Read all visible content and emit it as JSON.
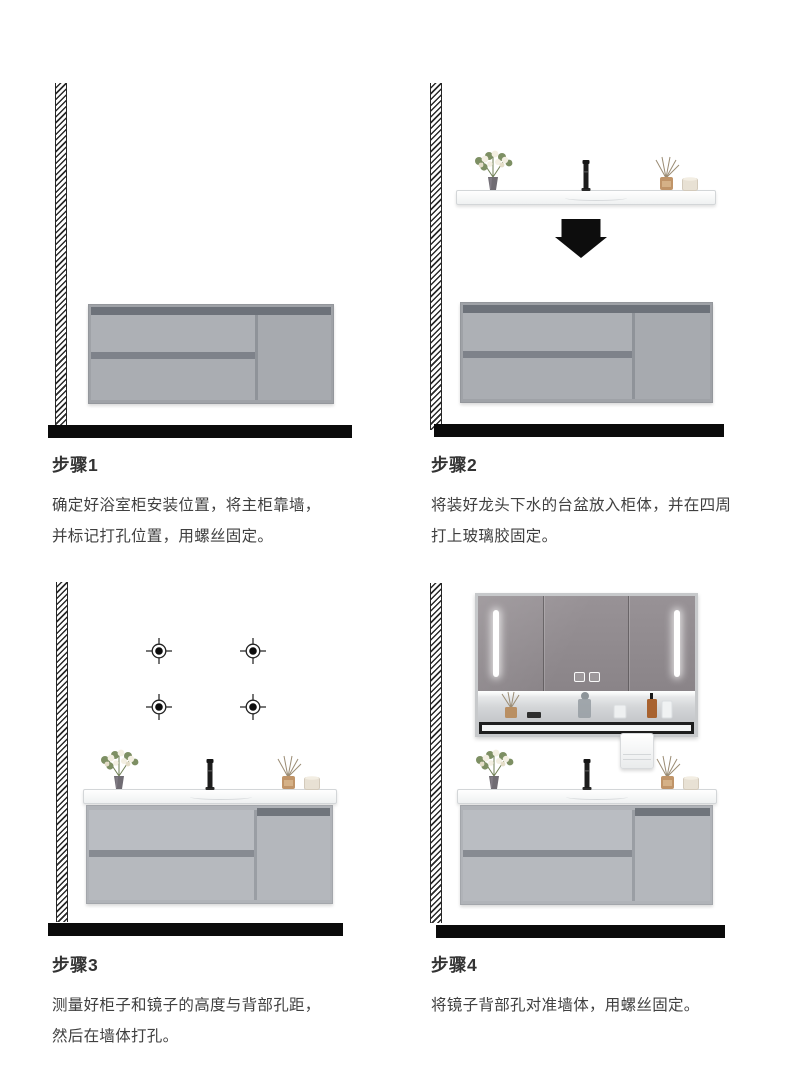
{
  "document": {
    "type": "installation-instructions",
    "subject": "bathroom vanity cabinet",
    "language": "zh-CN"
  },
  "steps": [
    {
      "id": 1,
      "title": "步骤1",
      "lines": [
        "确定好浴室柜安装位置，将主柜靠墙，",
        "并标记打孔位置，用螺丝固定。"
      ]
    },
    {
      "id": 2,
      "title": "步骤2",
      "lines": [
        "将装好龙头下水的台盆放入柜体，并在四周",
        "打上玻璃胶固定。"
      ]
    },
    {
      "id": 3,
      "title": "步骤3",
      "lines": [
        "测量好柜子和镜子的高度与背部孔距，",
        "然后在墙体打孔。"
      ]
    },
    {
      "id": 4,
      "title": "步骤4",
      "lines": [
        "将镜子背部孔对准墙体，用螺丝固定。"
      ]
    }
  ],
  "icons": [
    "wall-hatch",
    "floor-line",
    "vanity-cabinet",
    "drawer-upper",
    "drawer-lower",
    "cabinet-door",
    "countertop",
    "plant-icon",
    "faucet-icon",
    "reed-diffuser-icon",
    "candle-icon",
    "arrow-down-icon",
    "drill-mark-icon",
    "mirror-cabinet",
    "led-strip-icon",
    "touch-controls-icon",
    "mirror-shelf",
    "towel-bar",
    "towel-icon"
  ],
  "colors": {
    "background": "#ffffff",
    "text_title": "#333333",
    "text_body": "#404040",
    "floor": "#0b0b0b",
    "arrow": "#0d0d0d",
    "cabinet_body": "#abaeb3",
    "cabinet_recess": "#6d727a",
    "countertop": "#f2f4f5",
    "mirror_face": "#8e888b",
    "diffuser_bottle": "#c09468",
    "candle": "#e8e1d4"
  }
}
